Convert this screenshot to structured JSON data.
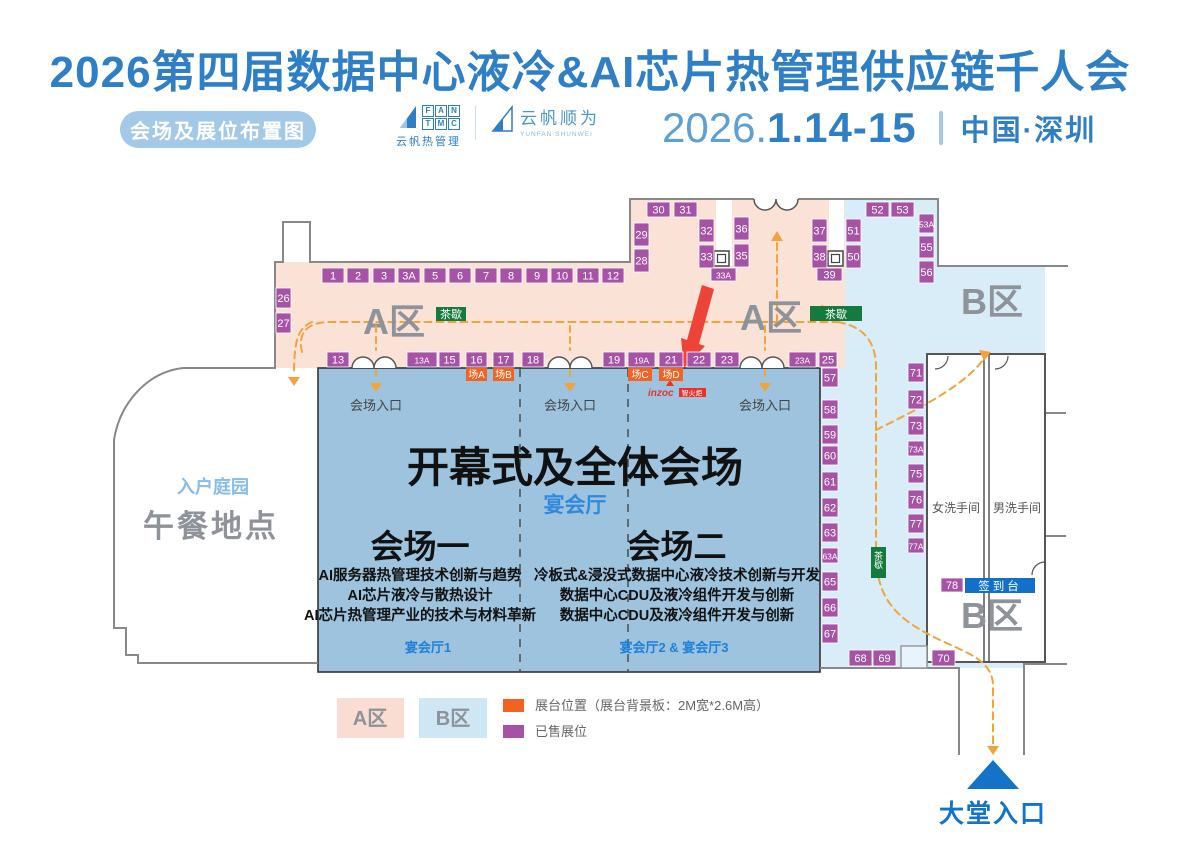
{
  "header": {
    "title": "2026第四届数据中心液冷&AI芯片热管理供应链千人会",
    "badge": "会场及展位布置图",
    "logo1": {
      "letters": [
        "F",
        "A",
        "N",
        "T",
        "M",
        "C"
      ],
      "name": "云帆热管理"
    },
    "logo2": {
      "name": "云帆顺为",
      "sub": "YUNFAN SHUNWEI"
    },
    "date_year": "2026.",
    "date_days": "1.14-15",
    "location": "中国·深圳"
  },
  "map": {
    "zone_a_label": "A区",
    "zone_b_label": "B区",
    "tea_break": "茶歇",
    "entrance_label": "会场入口",
    "stage_badges": [
      "场A",
      "场B",
      "场C",
      "场D"
    ],
    "sponsor": {
      "name": "inzoc",
      "suffix": "智火炬"
    },
    "hall": {
      "main_title": "开幕式及全体会场",
      "banquet": "宴会厅",
      "venue1": {
        "title": "会场一",
        "topics": [
          "AI服务器热管理技术创新与趋势",
          "AI芯片液冷与散热设计",
          "AI芯片热管理产业的技术与材料革新"
        ],
        "room": "宴会厅1"
      },
      "venue2": {
        "title": "会场二",
        "topics": [
          "冷板式&浸没式数据中心液冷技术创新与开发",
          "数据中心CDU及液冷组件开发与创新",
          "数据中心CDU及液冷组件开发与创新"
        ],
        "room": "宴会厅2 & 宴会厅3"
      }
    },
    "lunch": {
      "garden": "入户庭园",
      "label": "午餐地点"
    },
    "restrooms": {
      "female": "女洗手间",
      "male": "男洗手间"
    },
    "checkin": {
      "booth": "78",
      "label": "签到台"
    },
    "lobby_entrance": "大堂入口",
    "booths": {
      "a_top": [
        "1",
        "2",
        "3",
        "3A",
        "5",
        "6",
        "7",
        "8",
        "9",
        "10",
        "11",
        "12"
      ],
      "a_left": [
        "26",
        "27"
      ],
      "a_bottom": [
        "13",
        "13A",
        "15",
        "16",
        "17",
        "18",
        "19",
        "19A",
        "21",
        "22",
        "23",
        "23A",
        "25"
      ],
      "a_upper": [
        "30",
        "31",
        "29",
        "28",
        "32",
        "33",
        "33A",
        "36",
        "35",
        "37",
        "38",
        "39"
      ],
      "b_top": [
        "52",
        "53",
        "51",
        "50",
        "53A",
        "55",
        "56"
      ],
      "b_left": [
        "57",
        "58",
        "59",
        "60",
        "61",
        "62",
        "63",
        "63A",
        "65",
        "66",
        "67"
      ],
      "b_right": [
        "71",
        "72",
        "73",
        "73A",
        "75",
        "76",
        "77",
        "77A"
      ],
      "b_bottom": [
        "68",
        "69",
        "70"
      ]
    }
  },
  "legend": {
    "zone_a": "A区",
    "zone_b": "B区",
    "booth_position": "展台位置（展台背景板：2M宽*2.6M高）",
    "sold": "已售展位"
  },
  "colors": {
    "accent_blue": "#2E7FC5",
    "zone_a_fill": "#FBE2D7",
    "zone_b_fill": "#D9EDF8",
    "hall_fill": "#9DC3DE",
    "booth_purple": "#A653A6",
    "stage_orange": "#F26322",
    "tea_green": "#157A3D",
    "sign_blue": "#1170C9",
    "path_orange": "#F2A33C",
    "arrow_red": "#EE4338"
  }
}
